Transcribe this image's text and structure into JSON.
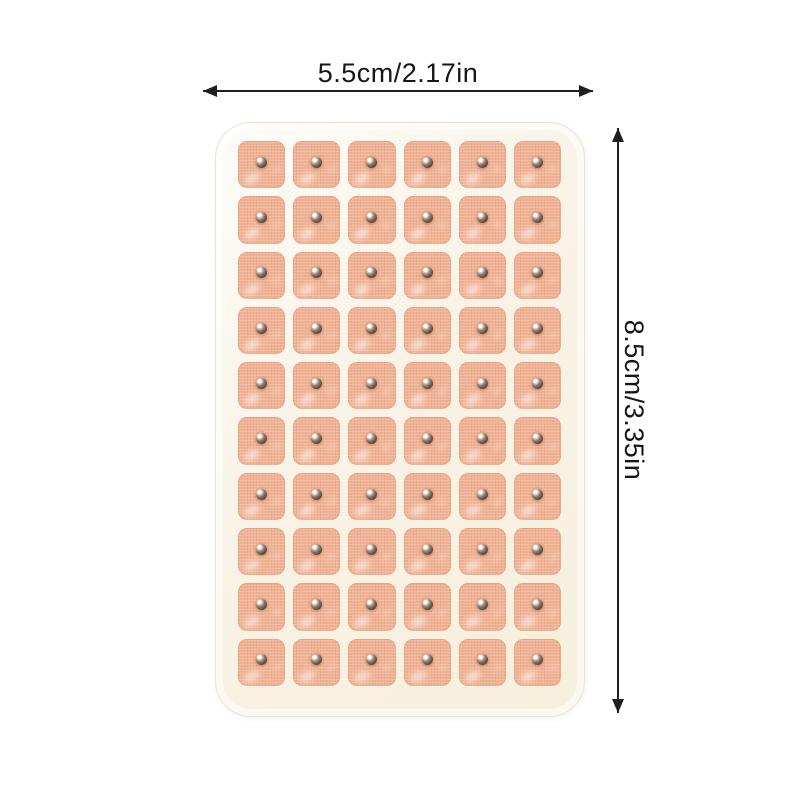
{
  "annotations": {
    "width_label": "5.5cm/2.17in",
    "height_label": "8.5cm/3.35in"
  },
  "sheet": {
    "rows": 10,
    "columns": 6,
    "patch_count": 60
  },
  "colors": {
    "arrow": "#1f1f1f",
    "label-text": "#161616",
    "sheet-base": "#f8f3e6",
    "sheet-rim": "#fdfcf9",
    "backing": "#f6efdc",
    "patch-base": "#f0b294",
    "patch-light": "#f7cdb3",
    "patch-edge": "#edaa8b",
    "bead-dark": "#4a3b31",
    "bead-mid": "#8a7565",
    "bead-highlight": "#ffffff"
  }
}
